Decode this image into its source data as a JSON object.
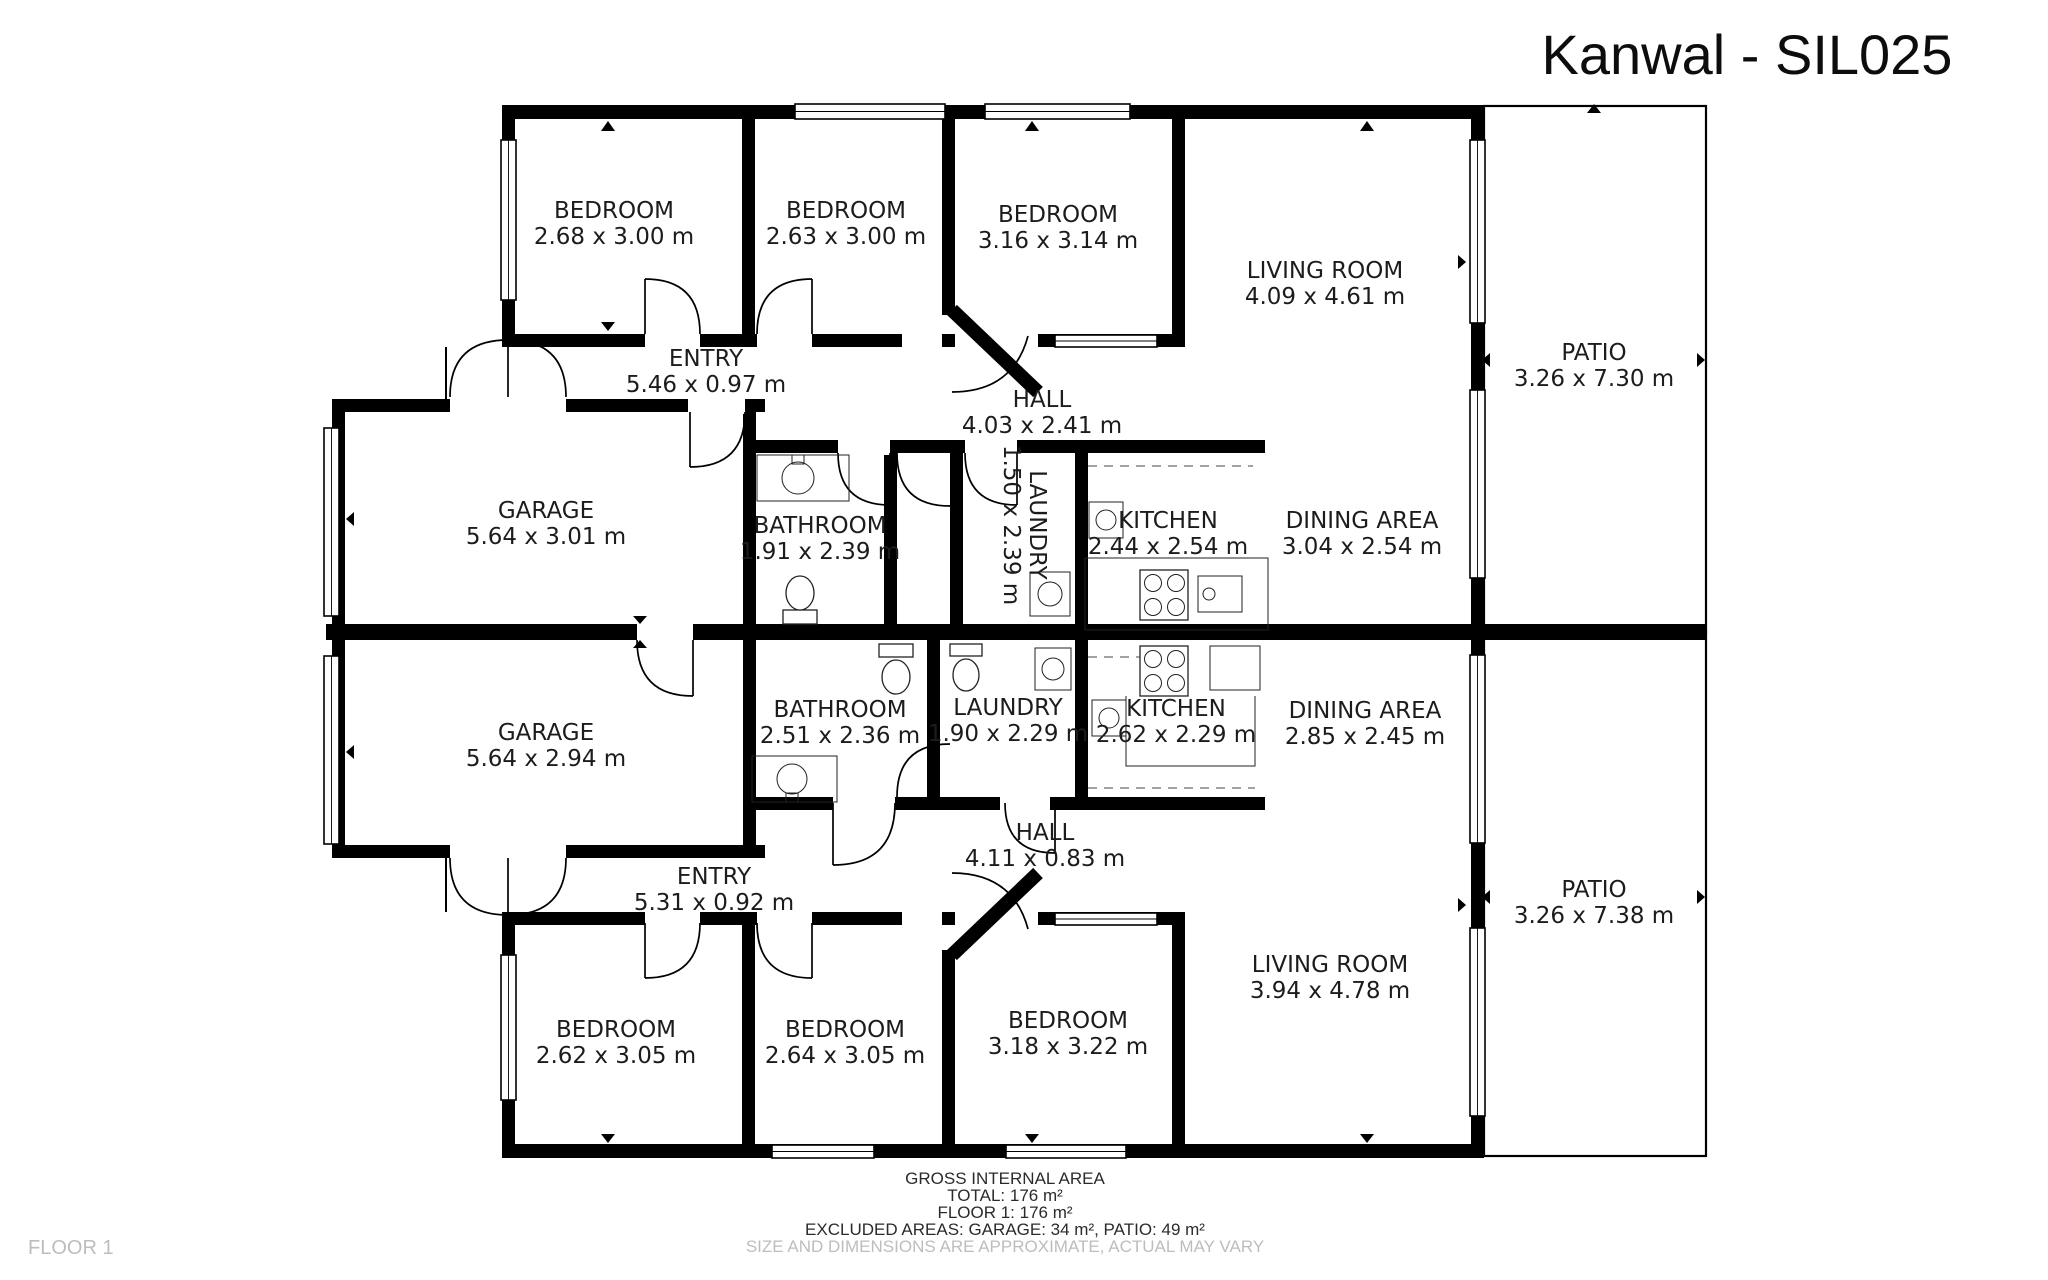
{
  "title": "Kanwal - SIL025",
  "floor_label": "FLOOR 1",
  "footer": {
    "heading": "GROSS INTERNAL AREA",
    "total": "TOTAL: 176 m²",
    "floor": "FLOOR 1: 176 m²",
    "excluded": "EXCLUDED AREAS: GARAGE: 34 m², PATIO: 49 m²",
    "disclaimer": "SIZE AND DIMENSIONS ARE APPROXIMATE, ACTUAL MAY VARY"
  },
  "colors": {
    "wall": "#000000",
    "label": "#1c1c1c",
    "muted": "#bdbdbd"
  },
  "rooms": {
    "bed_a1": {
      "name": "BEDROOM",
      "dims": "2.68 x 3.00 m"
    },
    "bed_a2": {
      "name": "BEDROOM",
      "dims": "2.63 x 3.00 m"
    },
    "bed_a3": {
      "name": "BEDROOM",
      "dims": "3.16 x 3.14 m"
    },
    "living_a": {
      "name": "LIVING ROOM",
      "dims": "4.09 x 4.61 m"
    },
    "patio_a": {
      "name": "PATIO",
      "dims": "3.26 x 7.30 m"
    },
    "entry_a": {
      "name": "ENTRY",
      "dims": "5.46 x 0.97 m"
    },
    "hall_a": {
      "name": "HALL",
      "dims": "4.03 x 2.41 m"
    },
    "garage_a": {
      "name": "GARAGE",
      "dims": "5.64 x 3.01 m"
    },
    "bathroom_a": {
      "name": "BATHROOM",
      "dims": "1.91 x 2.39 m"
    },
    "laundry_a": {
      "name": "LAUNDRY",
      "dims": "1.50 x 2.39 m"
    },
    "kitchen_a": {
      "name": "KITCHEN",
      "dims": "2.44 x 2.54 m"
    },
    "dining_a": {
      "name": "DINING AREA",
      "dims": "3.04 x 2.54 m"
    },
    "garage_b": {
      "name": "GARAGE",
      "dims": "5.64 x 2.94 m"
    },
    "bathroom_b": {
      "name": "BATHROOM",
      "dims": "2.51 x 2.36 m"
    },
    "laundry_b": {
      "name": "LAUNDRY",
      "dims": "1.90 x 2.29 m"
    },
    "kitchen_b": {
      "name": "KITCHEN",
      "dims": "2.62 x 2.29 m"
    },
    "dining_b": {
      "name": "DINING AREA",
      "dims": "2.85 x 2.45 m"
    },
    "hall_b": {
      "name": "HALL",
      "dims": "4.11 x 0.83 m"
    },
    "entry_b": {
      "name": "ENTRY",
      "dims": "5.31 x 0.92 m"
    },
    "living_b": {
      "name": "LIVING ROOM",
      "dims": "3.94 x 4.78 m"
    },
    "bed_b1": {
      "name": "BEDROOM",
      "dims": "2.62 x 3.05 m"
    },
    "bed_b2": {
      "name": "BEDROOM",
      "dims": "2.64 x 3.05 m"
    },
    "bed_b3": {
      "name": "BEDROOM",
      "dims": "3.18 x 3.22 m"
    },
    "patio_b": {
      "name": "PATIO",
      "dims": "3.26 x 7.38 m"
    }
  }
}
